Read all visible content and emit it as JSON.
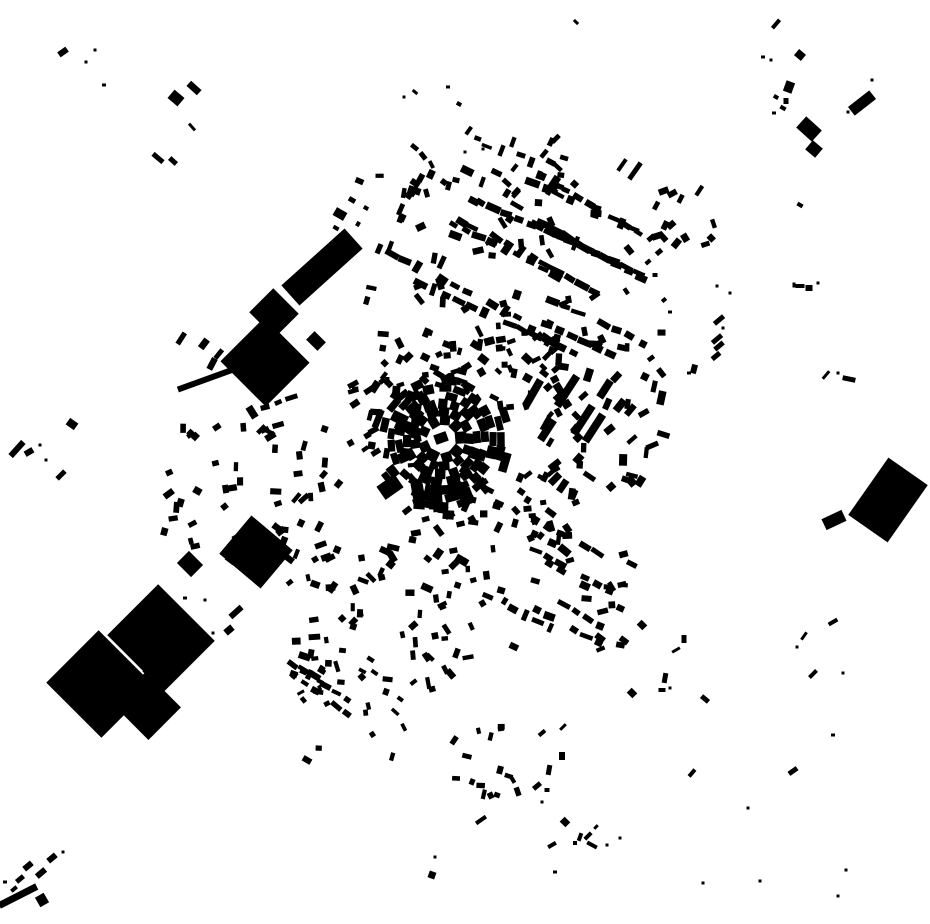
{
  "map": {
    "width": 930,
    "height": 924,
    "seed": 1337,
    "colors": {
      "background": "#ffffff",
      "building": "#000000"
    },
    "core_ring": {
      "cx": 442,
      "cy": 439,
      "rings": [
        {
          "r": 19,
          "n": 9,
          "w": 11,
          "skip": 0
        },
        {
          "r": 27,
          "n": 13,
          "w": 9,
          "skip": 0
        },
        {
          "r": 35,
          "n": 16,
          "w": 9,
          "skip": 0.05
        },
        {
          "r": 43,
          "n": 19,
          "w": 9,
          "skip": 0.05
        },
        {
          "r": 51,
          "n": 21,
          "w": 8,
          "skip": 0.12
        },
        {
          "r": 59,
          "n": 22,
          "w": 8,
          "skip": 0.3
        },
        {
          "r": 67,
          "n": 20,
          "w": 8,
          "skip": 0.55
        }
      ]
    },
    "landmarks": [
      [
        322,
        267,
        85,
        27,
        -42
      ],
      [
        274,
        313,
        36,
        34,
        45
      ],
      [
        265,
        362,
        64,
        62,
        45
      ],
      [
        316,
        341,
        16,
        12,
        45
      ],
      [
        256,
        552,
        54,
        50,
        40
      ],
      [
        190,
        564,
        20,
        17,
        45
      ],
      [
        100,
        684,
        78,
        74,
        45
      ],
      [
        161,
        638,
        80,
        72,
        45
      ],
      [
        147,
        706,
        50,
        46,
        45
      ],
      [
        133,
        652,
        10,
        8,
        45
      ],
      [
        148,
        672,
        9,
        7,
        45
      ],
      [
        236,
        612,
        15,
        6,
        -42
      ],
      [
        229,
        630,
        9,
        7,
        -40
      ],
      [
        888,
        500,
        70,
        48,
        -55
      ],
      [
        834,
        520,
        22,
        12,
        -25
      ],
      [
        441,
        438,
        13,
        10,
        -20
      ],
      [
        390,
        487,
        22,
        16,
        -35
      ],
      [
        437,
        495,
        34,
        10,
        85
      ],
      [
        418,
        492,
        18,
        12,
        80
      ],
      [
        455,
        487,
        26,
        9,
        95
      ],
      [
        567,
        391,
        36,
        8,
        -57
      ],
      [
        583,
        420,
        34,
        8,
        -57
      ],
      [
        594,
        428,
        32,
        8,
        -57
      ],
      [
        533,
        393,
        30,
        8,
        -60
      ],
      [
        547,
        430,
        24,
        8,
        -57
      ],
      [
        605,
        389,
        20,
        8,
        -57
      ],
      [
        622,
        165,
        14,
        4,
        -55
      ],
      [
        635,
        171,
        20,
        5,
        -55
      ],
      [
        207,
        379,
        62,
        6,
        -20
      ]
    ],
    "singles": [
      [
        63,
        52,
        10,
        6,
        -35
      ],
      [
        95,
        50,
        3,
        3,
        0
      ],
      [
        86,
        62,
        3,
        3,
        0
      ],
      [
        104,
        85,
        4,
        3,
        0
      ],
      [
        176,
        98,
        13,
        11,
        40
      ],
      [
        194,
        88,
        14,
        7,
        42
      ],
      [
        192,
        127,
        9,
        3,
        48
      ],
      [
        158,
        158,
        13,
        5,
        40
      ],
      [
        173,
        161,
        9,
        5,
        42
      ],
      [
        576,
        22,
        6,
        3,
        45
      ],
      [
        776,
        24,
        11,
        4,
        -50
      ],
      [
        763,
        57,
        4,
        3,
        0
      ],
      [
        771,
        60,
        3,
        3,
        0
      ],
      [
        800,
        55,
        9,
        8,
        40
      ],
      [
        789,
        87,
        9,
        11,
        20
      ],
      [
        786,
        101,
        5,
        6,
        0
      ],
      [
        776,
        97,
        5,
        4,
        30
      ],
      [
        783,
        108,
        6,
        4,
        30
      ],
      [
        774,
        113,
        4,
        3,
        0
      ],
      [
        809,
        129,
        21,
        15,
        42
      ],
      [
        814,
        149,
        13,
        12,
        40
      ],
      [
        862,
        103,
        27,
        11,
        -38
      ],
      [
        872,
        80,
        3,
        3,
        0
      ],
      [
        848,
        112,
        3,
        3,
        0
      ],
      [
        800,
        205,
        6,
        4,
        30
      ],
      [
        800,
        286,
        9,
        4,
        0
      ],
      [
        809,
        288,
        7,
        6,
        0
      ],
      [
        794,
        285,
        3,
        5,
        0
      ],
      [
        818,
        283,
        3,
        3,
        0
      ],
      [
        717,
        286,
        3,
        3,
        0
      ],
      [
        730,
        293,
        3,
        3,
        0
      ],
      [
        719,
        320,
        12,
        5,
        -40
      ],
      [
        723,
        328,
        3,
        3,
        0
      ],
      [
        717,
        339,
        12,
        5,
        -40
      ],
      [
        719,
        346,
        11,
        5,
        -40
      ],
      [
        716,
        356,
        10,
        5,
        -40
      ],
      [
        694,
        369,
        6,
        9,
        15
      ],
      [
        689,
        373,
        4,
        3,
        0
      ],
      [
        826,
        375,
        10,
        3,
        -50
      ],
      [
        838,
        373,
        3,
        3,
        0
      ],
      [
        849,
        379,
        13,
        5,
        12
      ],
      [
        833,
        622,
        10,
        4,
        -30
      ],
      [
        804,
        636,
        9,
        3,
        -55
      ],
      [
        797,
        647,
        3,
        3,
        0
      ],
      [
        813,
        674,
        10,
        4,
        -45
      ],
      [
        843,
        673,
        3,
        3,
        0
      ],
      [
        833,
        735,
        4,
        3,
        0
      ],
      [
        793,
        771,
        10,
        5,
        -35
      ],
      [
        692,
        773,
        9,
        4,
        -50
      ],
      [
        748,
        808,
        3,
        3,
        0
      ],
      [
        846,
        870,
        3,
        3,
        0
      ],
      [
        838,
        896,
        3,
        3,
        0
      ],
      [
        760,
        881,
        3,
        3,
        0
      ],
      [
        703,
        883,
        3,
        3,
        0
      ],
      [
        642,
        625,
        8,
        7,
        45
      ],
      [
        684,
        639,
        5,
        8,
        0
      ],
      [
        676,
        650,
        9,
        3,
        -30
      ],
      [
        632,
        693,
        8,
        7,
        45
      ],
      [
        662,
        690,
        7,
        4,
        0
      ],
      [
        670,
        688,
        3,
        3,
        0
      ],
      [
        665,
        678,
        5,
        10,
        10
      ],
      [
        705,
        699,
        9,
        5,
        40
      ],
      [
        563,
        727,
        8,
        3,
        -45
      ],
      [
        562,
        756,
        6,
        8,
        0
      ],
      [
        565,
        822,
        8,
        7,
        45
      ],
      [
        580,
        837,
        4,
        8,
        20
      ],
      [
        588,
        836,
        9,
        4,
        -45
      ],
      [
        592,
        845,
        11,
        4,
        28
      ],
      [
        575,
        843,
        4,
        4,
        0
      ],
      [
        596,
        827,
        5,
        3,
        -45
      ],
      [
        607,
        845,
        3,
        3,
        0
      ],
      [
        620,
        838,
        3,
        3,
        0
      ],
      [
        552,
        845,
        9,
        4,
        -30
      ],
      [
        555,
        872,
        4,
        3,
        0
      ],
      [
        542,
        733,
        8,
        4,
        -40
      ],
      [
        549,
        770,
        5,
        10,
        10
      ],
      [
        537,
        786,
        9,
        5,
        -40
      ],
      [
        547,
        790,
        5,
        4,
        0
      ],
      [
        542,
        802,
        3,
        3,
        0
      ],
      [
        435,
        857,
        3,
        3,
        0
      ],
      [
        432,
        875,
        7,
        7,
        20
      ],
      [
        307,
        760,
        9,
        6,
        30
      ],
      [
        17,
        449,
        19,
        6,
        -48
      ],
      [
        29,
        452,
        9,
        6,
        -30
      ],
      [
        40,
        445,
        3,
        3,
        0
      ],
      [
        72,
        424,
        10,
        8,
        35
      ],
      [
        61,
        475,
        11,
        5,
        -45
      ],
      [
        46,
        460,
        3,
        3,
        0
      ],
      [
        52,
        858,
        10,
        6,
        -40
      ],
      [
        28,
        866,
        10,
        6,
        -40
      ],
      [
        41,
        873,
        11,
        6,
        -40
      ],
      [
        20,
        879,
        9,
        5,
        -40
      ],
      [
        14,
        889,
        7,
        4,
        -40
      ],
      [
        18,
        896,
        42,
        7,
        -27
      ],
      [
        42,
        900,
        10,
        11,
        -30
      ],
      [
        63,
        852,
        3,
        3,
        0
      ],
      [
        5,
        882,
        4,
        3,
        0
      ],
      [
        213,
        633,
        3,
        3,
        0
      ],
      [
        185,
        598,
        4,
        3,
        0
      ],
      [
        205,
        600,
        3,
        3,
        0
      ],
      [
        340,
        214,
        12,
        9,
        30
      ],
      [
        352,
        200,
        7,
        5,
        30
      ],
      [
        336,
        228,
        6,
        4,
        30
      ],
      [
        358,
        224,
        5,
        4,
        -60
      ],
      [
        366,
        208,
        5,
        4,
        30
      ],
      [
        651,
        238,
        8,
        5,
        -40
      ],
      [
        659,
        252,
        7,
        5,
        -40
      ],
      [
        648,
        262,
        6,
        4,
        -40
      ],
      [
        655,
        275,
        5,
        4,
        0
      ],
      [
        664,
        300,
        5,
        4,
        -40
      ],
      [
        670,
        312,
        4,
        3,
        0
      ],
      [
        459,
        104,
        5,
        4,
        30
      ],
      [
        448,
        87,
        4,
        3,
        0
      ],
      [
        404,
        97,
        3,
        3,
        0
      ],
      [
        415,
        92,
        6,
        3,
        40
      ],
      [
        465,
        152,
        3,
        3,
        0
      ],
      [
        483,
        149,
        3,
        3,
        0
      ],
      [
        481,
        820,
        12,
        4,
        -35
      ],
      [
        497,
        795,
        6,
        5,
        20
      ],
      [
        500,
        770,
        6,
        8,
        15
      ]
    ],
    "clusters": [
      {
        "name": "ne-grid-rows-a",
        "type": "rows",
        "x": 350,
        "y": 160,
        "w": 295,
        "h": 195,
        "rowAngle": 27,
        "rows": 12,
        "perRow": 13,
        "spacing": 14,
        "houseL": 11,
        "houseW": 6,
        "jitter": 8,
        "skip": 0.25
      },
      {
        "name": "ne-grid-rows-b",
        "type": "rows",
        "x": 365,
        "y": 170,
        "w": 265,
        "h": 180,
        "rowAngle": -63,
        "rows": 9,
        "perRow": 10,
        "spacing": 15,
        "houseL": 10,
        "houseW": 6,
        "jitter": 8,
        "skip": 0.4
      },
      {
        "name": "ne-grid-fill",
        "type": "scatter",
        "x": 355,
        "y": 175,
        "w": 280,
        "h": 175,
        "count": 40,
        "minL": 6,
        "maxL": 12,
        "minW": 4,
        "maxW": 7,
        "angle": 27,
        "jitter": 60
      },
      {
        "name": "north-trail",
        "type": "rows",
        "x": 400,
        "y": 85,
        "w": 95,
        "h": 85,
        "rowAngle": 42,
        "rows": 2,
        "perRow": 8,
        "spacing": 12,
        "houseL": 8,
        "houseW": 5,
        "jitter": 25,
        "skip": 0.3
      },
      {
        "name": "north-strips",
        "type": "scatter",
        "x": 495,
        "y": 138,
        "w": 72,
        "h": 58,
        "count": 22,
        "minL": 8,
        "maxL": 13,
        "minW": 4,
        "maxW": 6,
        "angle": -60,
        "jitter": 15
      },
      {
        "name": "ne-outlier-cluster",
        "type": "scatter",
        "x": 655,
        "y": 185,
        "w": 60,
        "h": 65,
        "count": 14,
        "minL": 7,
        "maxL": 12,
        "minW": 4,
        "maxW": 7,
        "angle": -40,
        "jitter": 30
      },
      {
        "name": "east-fabric",
        "type": "scatter",
        "x": 545,
        "y": 330,
        "w": 120,
        "h": 170,
        "count": 55,
        "minL": 7,
        "maxL": 14,
        "minW": 4,
        "maxW": 8,
        "angle": -55,
        "jitter": 35
      },
      {
        "name": "ne-of-core",
        "type": "scatter",
        "x": 455,
        "y": 328,
        "w": 112,
        "h": 82,
        "count": 42,
        "minL": 6,
        "maxL": 12,
        "minW": 4,
        "maxW": 8,
        "angle": 20,
        "jitter": 55
      },
      {
        "name": "n-of-core",
        "type": "scatter",
        "x": 378,
        "y": 328,
        "w": 90,
        "h": 62,
        "count": 26,
        "minL": 6,
        "maxL": 11,
        "minW": 4,
        "maxW": 7,
        "angle": 60,
        "jitter": 55
      },
      {
        "name": "w-of-core",
        "type": "scatter",
        "x": 348,
        "y": 372,
        "w": 72,
        "h": 108,
        "count": 30,
        "minL": 6,
        "maxL": 12,
        "minW": 4,
        "maxW": 8,
        "angle": -30,
        "jitter": 55
      },
      {
        "name": "se-of-core",
        "type": "scatter",
        "x": 460,
        "y": 468,
        "w": 92,
        "h": 72,
        "count": 28,
        "minL": 6,
        "maxL": 11,
        "minW": 4,
        "maxW": 7,
        "angle": -20,
        "jitter": 55
      },
      {
        "name": "s-of-core",
        "type": "scatter",
        "x": 382,
        "y": 500,
        "w": 82,
        "h": 68,
        "count": 20,
        "minL": 7,
        "maxL": 14,
        "minW": 5,
        "maxW": 9,
        "angle": 0,
        "jitter": 45
      },
      {
        "name": "se-rows",
        "type": "rows",
        "x": 468,
        "y": 505,
        "w": 172,
        "h": 142,
        "rowAngle": 30,
        "rows": 8,
        "perRow": 9,
        "spacing": 14,
        "houseL": 10,
        "houseW": 6,
        "jitter": 9,
        "skip": 0.3
      },
      {
        "name": "se-fill",
        "type": "scatter",
        "x": 470,
        "y": 500,
        "w": 175,
        "h": 150,
        "count": 30,
        "minL": 6,
        "maxL": 11,
        "minW": 4,
        "maxW": 7,
        "angle": 30,
        "jitter": 55
      },
      {
        "name": "south-fabric",
        "type": "scatter",
        "x": 285,
        "y": 555,
        "w": 190,
        "h": 140,
        "count": 65,
        "minL": 6,
        "maxL": 12,
        "minW": 4,
        "maxW": 7,
        "angle": 45,
        "jitter": 55
      },
      {
        "name": "sw-trail-rows",
        "type": "rows",
        "x": 280,
        "y": 650,
        "w": 150,
        "h": 120,
        "rowAngle": 33,
        "rows": 4,
        "perRow": 7,
        "spacing": 13,
        "houseL": 9,
        "houseW": 5,
        "jitter": 9,
        "skip": 0.35
      },
      {
        "name": "sw-trail-fill",
        "type": "scatter",
        "x": 285,
        "y": 660,
        "w": 150,
        "h": 110,
        "count": 16,
        "minL": 5,
        "maxL": 9,
        "minW": 3,
        "maxW": 6,
        "angle": 40,
        "jitter": 55
      },
      {
        "name": "west-fabric",
        "type": "scatter",
        "x": 160,
        "y": 425,
        "w": 185,
        "h": 135,
        "count": 55,
        "minL": 6,
        "maxL": 12,
        "minW": 4,
        "maxW": 7,
        "angle": -40,
        "jitter": 50
      },
      {
        "name": "nw-rows",
        "type": "rows",
        "x": 176,
        "y": 336,
        "w": 60,
        "h": 45,
        "rowAngle": -58,
        "rows": 3,
        "perRow": 4,
        "spacing": 12,
        "houseL": 12,
        "houseW": 6,
        "jitter": 10,
        "skip": 0.25
      },
      {
        "name": "nw-street-rows",
        "type": "rows",
        "x": 185,
        "y": 388,
        "w": 150,
        "h": 52,
        "rowAngle": -22,
        "rows": 3,
        "perRow": 8,
        "spacing": 14,
        "houseL": 10,
        "houseW": 6,
        "jitter": 12,
        "skip": 0.3
      },
      {
        "name": "s-outlying-cluster",
        "type": "scatter",
        "x": 445,
        "y": 725,
        "w": 75,
        "h": 78,
        "count": 14,
        "minL": 6,
        "maxL": 10,
        "minW": 4,
        "maxW": 6,
        "angle": 40,
        "jitter": 45
      }
    ]
  }
}
